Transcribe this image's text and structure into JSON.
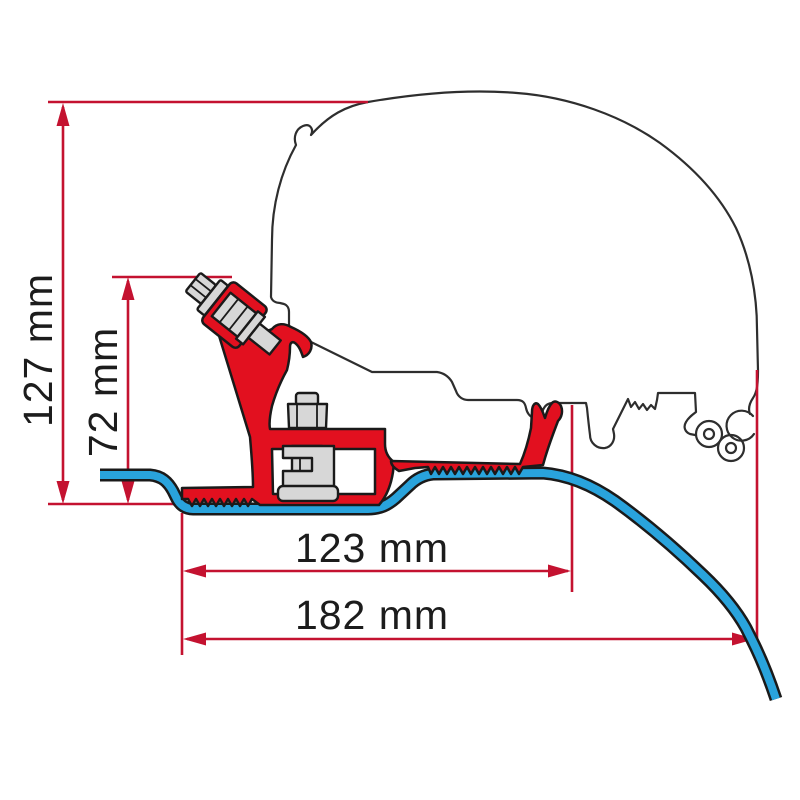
{
  "diagram": {
    "type": "technical-dimension-drawing",
    "subject": "awning roof-adapter bracket cross-section on van roof profile",
    "dimensions": {
      "height_overall": {
        "label": "127 mm",
        "orientation": "vertical"
      },
      "height_bracket": {
        "label": "72 mm",
        "orientation": "vertical"
      },
      "width_inner": {
        "label": "123 mm",
        "orientation": "horizontal"
      },
      "width_overall": {
        "label": "182 mm",
        "orientation": "horizontal"
      }
    }
  },
  "colors": {
    "dimension": "#c41230",
    "bracket": "#e2101f",
    "rail": "#29a3dc",
    "metal": "#d7d7d7",
    "outline": "#2e2e2e",
    "text": "#1c1c1c",
    "background": "#ffffff"
  }
}
